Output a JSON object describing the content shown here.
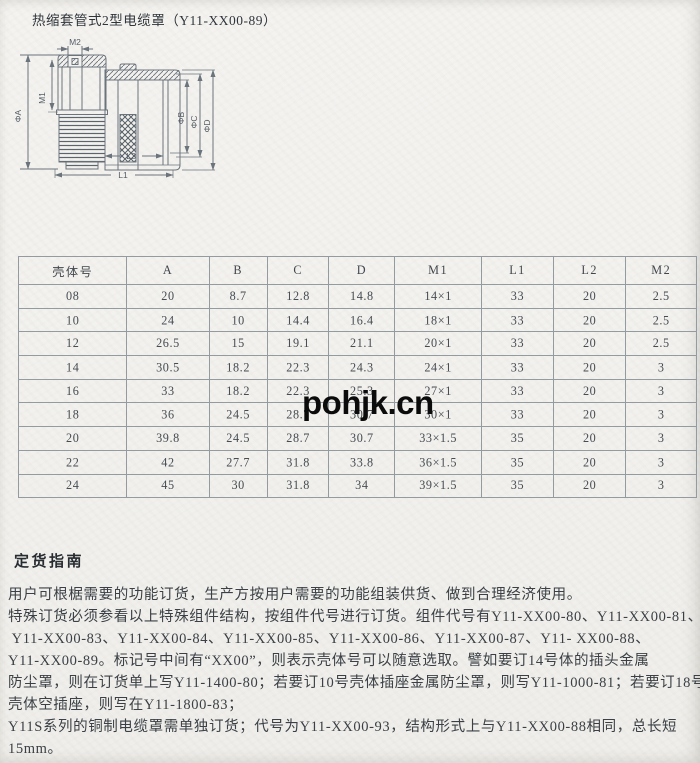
{
  "page": {
    "title": "热缩套管式2型电缆罩（Y11-XX00-89）",
    "watermark": "pohjk.cn"
  },
  "diagram": {
    "labels": {
      "m2": "M2",
      "phiA": "ΦA",
      "m1": "M1",
      "phiB": "ΦB",
      "phiC": "ΦC",
      "phiD": "ΦD",
      "l2": "L2",
      "l1": "L1"
    }
  },
  "table": {
    "headers": [
      "壳体号",
      "A",
      "B",
      "C",
      "D",
      "M1",
      "L1",
      "L2",
      "M2"
    ],
    "rows": [
      [
        "08",
        "20",
        "8.7",
        "12.8",
        "14.8",
        "14×1",
        "33",
        "20",
        "2.5"
      ],
      [
        "10",
        "24",
        "10",
        "14.4",
        "16.4",
        "18×1",
        "33",
        "20",
        "2.5"
      ],
      [
        "12",
        "26.5",
        "15",
        "19.1",
        "21.1",
        "20×1",
        "33",
        "20",
        "2.5"
      ],
      [
        "14",
        "30.5",
        "18.2",
        "22.3",
        "24.3",
        "24×1",
        "33",
        "20",
        "3"
      ],
      [
        "16",
        "33",
        "18.2",
        "22.3",
        "25.3",
        "27×1",
        "33",
        "20",
        "3"
      ],
      [
        "18",
        "36",
        "24.5",
        "28.7",
        "30.7",
        "30×1",
        "33",
        "20",
        "3"
      ],
      [
        "20",
        "39.8",
        "24.5",
        "28.7",
        "30.7",
        "33×1.5",
        "35",
        "20",
        "3"
      ],
      [
        "22",
        "42",
        "27.7",
        "31.8",
        "33.8",
        "36×1.5",
        "35",
        "20",
        "3"
      ],
      [
        "24",
        "45",
        "30",
        "31.8",
        "34",
        "39×1.5",
        "35",
        "20",
        "3"
      ]
    ]
  },
  "guide": {
    "heading": "定货指南",
    "lines": [
      "用户可根椐需要的功能订货，生产方按用户需要的功能组装供货、做到合理经济使用。",
      "特殊订货必须参看以上特殊组件结构，按组件代号进行订货。组件代号有Y11-XX00-80、Y11-XX00-81、",
      " Y11-XX00-83、Y11-XX00-84、Y11-XX00-85、Y11-XX00-86、Y11-XX00-87、Y11- XX00-88、",
      "Y11-XX00-89。标记号中间有“XX00”，则表示壳体号可以随意选取。譬如要订14号体的插头金属",
      "防尘罩，则在订货单上写Y11-1400-80；若要订10号壳体插座金属防尘罩，则写Y11-1000-81；若要订18号",
      "壳体空插座，则写在Y11-1800-83；",
      "Y11S系列的铜制电缆罩需单独订货；代号为Y11-XX00-93，结构形式上与Y11-XX00-88相同，总长短",
      "15mm。"
    ]
  }
}
